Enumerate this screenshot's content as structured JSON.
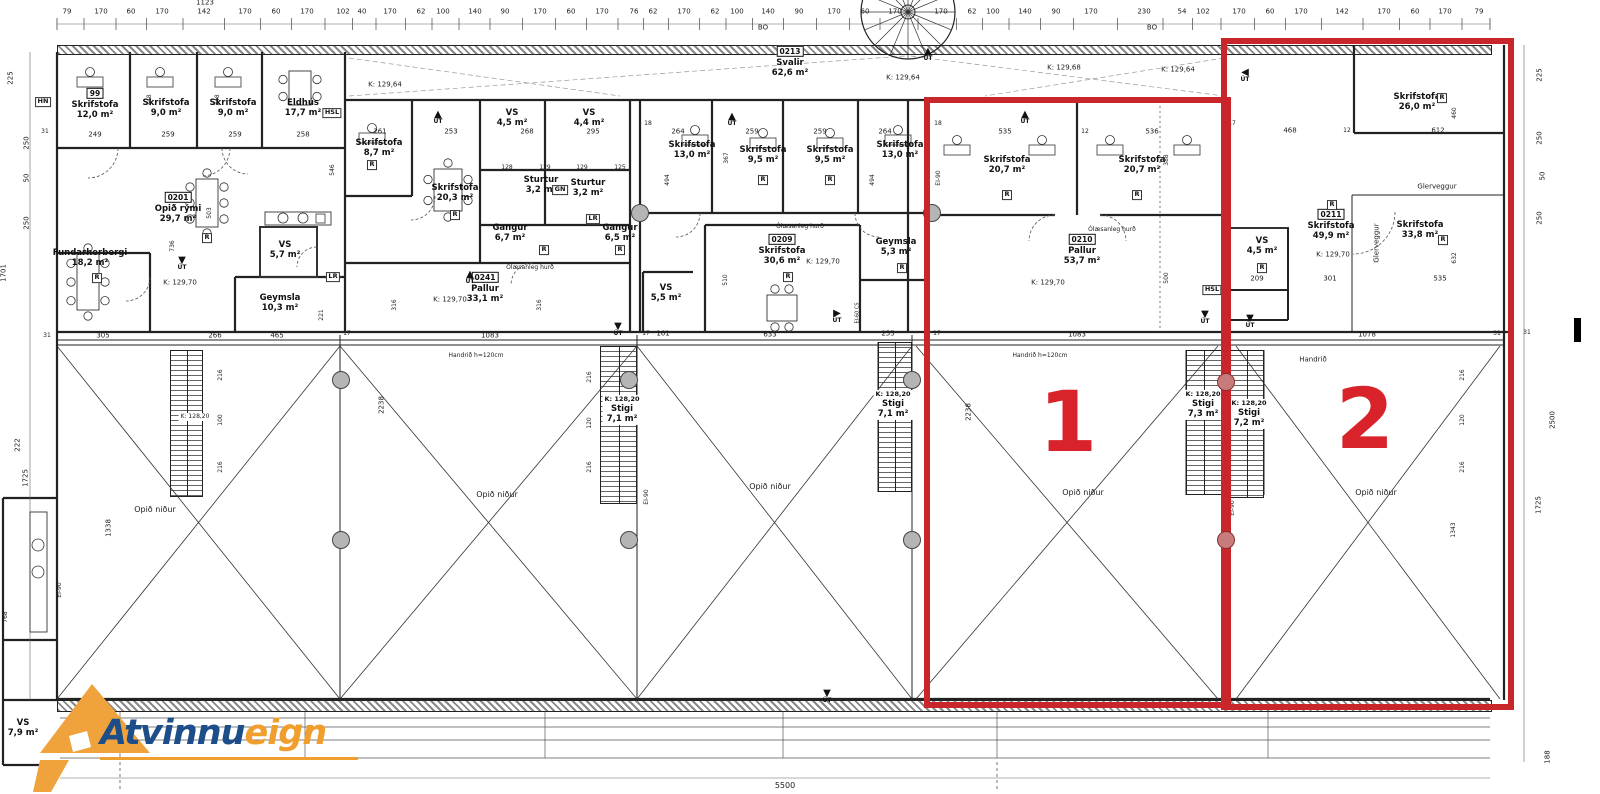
{
  "colors": {
    "red": "#c9262c",
    "red_number": "#d8232b",
    "logo_blue": "#1d4e89",
    "logo_orange": "#f09f2e"
  },
  "logo": {
    "word1": "Atvinnu",
    "word2": "eign"
  },
  "zones": [
    {
      "number": "1",
      "x": 924,
      "y": 97,
      "w": 307,
      "h": 611,
      "num_x": 1068,
      "num_y": 422
    },
    {
      "number": "2",
      "x": 1221,
      "y": 38,
      "w": 293,
      "h": 672,
      "num_x": 1365,
      "num_y": 419
    }
  ],
  "rooms": [
    {
      "id": "99",
      "n": "Skrifstofa",
      "a": "12,0 m²",
      "x": 95,
      "y": 104
    },
    {
      "n": "Skrifstofa",
      "a": "9,0 m²",
      "x": 166,
      "y": 108
    },
    {
      "n": "Skrifstofa",
      "a": "9,0 m²",
      "x": 233,
      "y": 108
    },
    {
      "n": "Eldhús",
      "a": "17,7 m²",
      "x": 303,
      "y": 108
    },
    {
      "id": "0201",
      "n": "Opið rými",
      "a": "29,7 m²",
      "x": 178,
      "y": 208
    },
    {
      "n": "Fundarherbergi",
      "a": "18,2 m²",
      "x": 90,
      "y": 258
    },
    {
      "n": "VS",
      "a": "5,7 m²",
      "x": 285,
      "y": 250
    },
    {
      "n": "Geymsla",
      "a": "10,3 m²",
      "x": 280,
      "y": 303
    },
    {
      "n": "Skrifstofa",
      "a": "8,7 m²",
      "x": 379,
      "y": 148
    },
    {
      "n": "Skrifstofa",
      "a": "20,3 m²",
      "x": 455,
      "y": 193
    },
    {
      "n": "VS",
      "a": "4,5 m²",
      "x": 512,
      "y": 118
    },
    {
      "n": "VS",
      "a": "4,4 m²",
      "x": 589,
      "y": 118
    },
    {
      "n": "Sturtur",
      "a": "3,2 m²",
      "x": 541,
      "y": 185
    },
    {
      "n": "Sturtur",
      "a": "3,2 m²",
      "x": 588,
      "y": 188
    },
    {
      "n": "Gangur",
      "a": "6,7 m²",
      "x": 510,
      "y": 233
    },
    {
      "n": "Gangur",
      "a": "6,5 m²",
      "x": 620,
      "y": 233
    },
    {
      "id": "0241",
      "n": "Pallur",
      "a": "33,1 m²",
      "x": 485,
      "y": 288
    },
    {
      "n": "Skrifstofa",
      "a": "13,0 m²",
      "x": 692,
      "y": 150
    },
    {
      "n": "Skrifstofa",
      "a": "9,5 m²",
      "x": 763,
      "y": 155
    },
    {
      "n": "Skrifstofa",
      "a": "9,5 m²",
      "x": 830,
      "y": 155
    },
    {
      "n": "Skrifstofa",
      "a": "13,0 m²",
      "x": 900,
      "y": 150
    },
    {
      "id": "0209",
      "n": "Skrifstofa",
      "a": "30,6 m²",
      "x": 782,
      "y": 250
    },
    {
      "n": "Geymsla",
      "a": "5,3 m²",
      "x": 896,
      "y": 247
    },
    {
      "n": "VS",
      "a": "5,5 m²",
      "x": 666,
      "y": 293
    },
    {
      "id": "0213",
      "n": "Svalir",
      "a": "62,6 m²",
      "x": 790,
      "y": 62
    },
    {
      "n": "Skrifstofa",
      "a": "20,7 m²",
      "x": 1007,
      "y": 165
    },
    {
      "n": "Skrifstofa",
      "a": "20,7 m²",
      "x": 1142,
      "y": 165
    },
    {
      "id": "0210",
      "n": "Pallur",
      "a": "53,7 m²",
      "x": 1082,
      "y": 250
    },
    {
      "n": "Skrifstofa",
      "a": "26,0 m²",
      "x": 1417,
      "y": 102
    },
    {
      "id": "0211",
      "n": "Skrifstofa",
      "a": "49,9 m²",
      "x": 1331,
      "y": 225
    },
    {
      "n": "Skrifstofa",
      "a": "33,8 m²",
      "x": 1420,
      "y": 230
    },
    {
      "n": "VS",
      "a": "4,5 m²",
      "x": 1262,
      "y": 246
    },
    {
      "n": "VS",
      "a": "7,9 m²",
      "x": 23,
      "y": 728
    },
    {
      "n": "Stigi",
      "a": "7,1 m²",
      "k": "K: 128,20",
      "x": 622,
      "y": 410,
      "bg": 1
    },
    {
      "n": "Stigi",
      "a": "7,1 m²",
      "k": "K: 128,20",
      "x": 893,
      "y": 405,
      "bg": 1
    },
    {
      "n": "Stigi",
      "a": "7,3 m²",
      "k": "K: 128,20",
      "x": 1203,
      "y": 405,
      "bg": 1
    },
    {
      "n": "Stigi",
      "a": "7,2 m²",
      "k": "K: 128,20",
      "x": 1249,
      "y": 414,
      "bg": 1
    }
  ],
  "labels": [
    [
      "79",
      67,
      12,
      7
    ],
    [
      "170",
      101,
      12,
      7
    ],
    [
      "60",
      131,
      12,
      7
    ],
    [
      "170",
      162,
      12,
      7
    ],
    [
      "142",
      204,
      12,
      7
    ],
    [
      "170",
      245,
      12,
      7
    ],
    [
      "60",
      276,
      12,
      7
    ],
    [
      "170",
      307,
      12,
      7
    ],
    [
      "102",
      343,
      12,
      7
    ],
    [
      "40",
      362,
      12,
      7
    ],
    [
      "170",
      390,
      12,
      7
    ],
    [
      "62",
      421,
      12,
      7
    ],
    [
      "100",
      443,
      12,
      7
    ],
    [
      "140",
      475,
      12,
      7
    ],
    [
      "90",
      505,
      12,
      7
    ],
    [
      "170",
      540,
      12,
      7
    ],
    [
      "60",
      571,
      12,
      7
    ],
    [
      "170",
      602,
      12,
      7
    ],
    [
      "76",
      634,
      12,
      7
    ],
    [
      "62",
      653,
      12,
      7
    ],
    [
      "170",
      684,
      12,
      7
    ],
    [
      "62",
      715,
      12,
      7
    ],
    [
      "100",
      737,
      12,
      7
    ],
    [
      "140",
      768,
      12,
      7
    ],
    [
      "90",
      799,
      12,
      7
    ],
    [
      "170",
      834,
      12,
      7
    ],
    [
      "60",
      865,
      12,
      7
    ],
    [
      "170",
      895,
      12,
      7
    ],
    [
      "170",
      941,
      12,
      7
    ],
    [
      "62",
      972,
      12,
      7
    ],
    [
      "100",
      993,
      12,
      7
    ],
    [
      "140",
      1025,
      12,
      7
    ],
    [
      "90",
      1056,
      12,
      7
    ],
    [
      "170",
      1091,
      12,
      7
    ],
    [
      "230",
      1144,
      12,
      7
    ],
    [
      "54",
      1182,
      12,
      7
    ],
    [
      "102",
      1203,
      12,
      7
    ],
    [
      "170",
      1239,
      12,
      7
    ],
    [
      "60",
      1270,
      12,
      7
    ],
    [
      "170",
      1301,
      12,
      7
    ],
    [
      "142",
      1342,
      12,
      7
    ],
    [
      "170",
      1384,
      12,
      7
    ],
    [
      "60",
      1415,
      12,
      7
    ],
    [
      "170",
      1445,
      12,
      7
    ],
    [
      "79",
      1479,
      12,
      7
    ],
    [
      "1123",
      205,
      3,
      7
    ],
    [
      "BO",
      763,
      28,
      7
    ],
    [
      "BO",
      1152,
      28,
      7
    ],
    [
      "225",
      11,
      78,
      7,
      1
    ],
    [
      "250",
      27,
      143,
      7,
      1
    ],
    [
      "50",
      27,
      178,
      7,
      1
    ],
    [
      "250",
      27,
      223,
      7,
      1
    ],
    [
      "1701",
      4,
      273,
      7,
      1
    ],
    [
      "222",
      18,
      445,
      7,
      1
    ],
    [
      "1725",
      26,
      478,
      7,
      1
    ],
    [
      "31",
      45,
      132,
      6
    ],
    [
      "31",
      47,
      336,
      6
    ],
    [
      "225",
      1540,
      75,
      7,
      1
    ],
    [
      "250",
      1540,
      138,
      7,
      1
    ],
    [
      "50",
      1543,
      176,
      7,
      1
    ],
    [
      "250",
      1540,
      218,
      7,
      1
    ],
    [
      "2500",
      1553,
      420,
      7,
      1
    ],
    [
      "1725",
      1539,
      505,
      7,
      1
    ],
    [
      "188",
      1548,
      757,
      7,
      1
    ],
    [
      "31",
      1527,
      333,
      6
    ],
    [
      "305",
      103,
      336,
      7
    ],
    [
      "266",
      215,
      336,
      7
    ],
    [
      "465",
      277,
      336,
      7
    ],
    [
      "1083",
      490,
      336,
      7
    ],
    [
      "161",
      663,
      334,
      7
    ],
    [
      "633",
      770,
      335,
      7
    ],
    [
      "255",
      888,
      334,
      7
    ],
    [
      "1083",
      1077,
      335,
      7
    ],
    [
      "1078",
      1367,
      335,
      7
    ],
    [
      "17",
      347,
      334,
      6
    ],
    [
      "17",
      646,
      334,
      6
    ],
    [
      "17",
      937,
      334,
      6
    ],
    [
      "31",
      1497,
      334,
      6
    ],
    [
      "249",
      95,
      135,
      7
    ],
    [
      "259",
      168,
      135,
      7
    ],
    [
      "259",
      235,
      135,
      7
    ],
    [
      "258",
      303,
      135,
      7
    ],
    [
      "261",
      380,
      132,
      7
    ],
    [
      "253",
      451,
      132,
      7
    ],
    [
      "268",
      527,
      132,
      7
    ],
    [
      "295",
      593,
      132,
      7
    ],
    [
      "264",
      678,
      132,
      7
    ],
    [
      "259",
      752,
      132,
      7
    ],
    [
      "259",
      820,
      132,
      7
    ],
    [
      "264",
      885,
      132,
      7
    ],
    [
      "535",
      1005,
      132,
      7
    ],
    [
      "536",
      1152,
      132,
      7
    ],
    [
      "468",
      1290,
      131,
      7
    ],
    [
      "612",
      1438,
      131,
      7
    ],
    [
      "18",
      648,
      124,
      6
    ],
    [
      "18",
      938,
      124,
      6
    ],
    [
      "12",
      1085,
      132,
      6
    ],
    [
      "17",
      1232,
      124,
      6
    ],
    [
      "12",
      1347,
      131,
      6
    ],
    [
      "128",
      507,
      168,
      6
    ],
    [
      "129",
      545,
      168,
      6
    ],
    [
      "129",
      582,
      168,
      6
    ],
    [
      "125",
      620,
      168,
      6
    ],
    [
      "209",
      1257,
      279,
      7
    ],
    [
      "301",
      1330,
      279,
      7
    ],
    [
      "535",
      1440,
      279,
      7
    ],
    [
      "348",
      150,
      100,
      6,
      1
    ],
    [
      "348",
      218,
      100,
      6,
      1
    ],
    [
      "546",
      333,
      170,
      6,
      1
    ],
    [
      "367",
      727,
      158,
      6,
      1
    ],
    [
      "494",
      668,
      180,
      6,
      1
    ],
    [
      "494",
      873,
      180,
      6,
      1
    ],
    [
      "388",
      1167,
      160,
      6,
      1
    ],
    [
      "500",
      1167,
      278,
      6,
      1
    ],
    [
      "510",
      726,
      280,
      6,
      1
    ],
    [
      "503",
      210,
      213,
      6,
      1
    ],
    [
      "736",
      173,
      246,
      6,
      1
    ],
    [
      "316",
      395,
      305,
      6,
      1
    ],
    [
      "316",
      540,
      305,
      6,
      1
    ],
    [
      "221",
      322,
      315,
      6,
      1
    ],
    [
      "768",
      6,
      617,
      6,
      1
    ],
    [
      "460",
      1455,
      113,
      6,
      1
    ],
    [
      "632",
      1455,
      258,
      6,
      1
    ],
    [
      "1338",
      109,
      528,
      7,
      1
    ],
    [
      "1343",
      1454,
      530,
      6,
      1
    ],
    [
      "2238",
      382,
      405,
      7,
      1
    ],
    [
      "2238",
      969,
      412,
      7,
      1
    ],
    [
      "216",
      221,
      375,
      6,
      1
    ],
    [
      "100",
      221,
      420,
      6,
      1
    ],
    [
      "216",
      221,
      467,
      6,
      1
    ],
    [
      "216",
      590,
      377,
      6,
      1
    ],
    [
      "120",
      590,
      423,
      6,
      1
    ],
    [
      "216",
      590,
      467,
      6,
      1
    ],
    [
      "216",
      1463,
      375,
      6,
      1
    ],
    [
      "120",
      1463,
      420,
      6,
      1
    ],
    [
      "216",
      1463,
      467,
      6,
      1
    ],
    [
      "EI-90",
      939,
      178,
      6,
      1
    ],
    [
      "EI-90",
      647,
      497,
      6,
      1
    ],
    [
      "EI-90",
      1233,
      508,
      6,
      1
    ],
    [
      "EI-90",
      60,
      590,
      6,
      1
    ],
    [
      "EI-60 CS",
      858,
      313,
      5,
      1
    ],
    [
      "Ólæsanleg hurð",
      530,
      268,
      6
    ],
    [
      "Ólæsanleg hurð",
      800,
      227,
      6
    ],
    [
      "Ólæsanleg hurð",
      1112,
      230,
      6
    ],
    [
      "Handrið h=120cm",
      476,
      356,
      6
    ],
    [
      "Handrið h=120cm",
      1040,
      356,
      6
    ],
    [
      "Handrið",
      1313,
      360,
      7
    ],
    [
      "Glerveggur",
      1437,
      187,
      7
    ],
    [
      "Glerveggur",
      1377,
      243,
      7,
      1
    ],
    [
      "Opið niður",
      155,
      510,
      8
    ],
    [
      "Opið niður",
      497,
      495,
      8
    ],
    [
      "Opið niður",
      770,
      487,
      8
    ],
    [
      "Opið niður",
      1083,
      493,
      8
    ],
    [
      "Opið niður",
      1376,
      493,
      8
    ],
    [
      "5500",
      785,
      786,
      8
    ],
    [
      "K: 129,64",
      385,
      85,
      7
    ],
    [
      "K: 129,64",
      903,
      78,
      7
    ],
    [
      "K: 129,64",
      1178,
      70,
      7
    ],
    [
      "K: 129,68",
      1064,
      68,
      7
    ],
    [
      "K: 129,70",
      180,
      283,
      7
    ],
    [
      "K: 129,70",
      450,
      300,
      7
    ],
    [
      "K: 129,70",
      823,
      262,
      7
    ],
    [
      "K: 129,70",
      1048,
      283,
      7
    ],
    [
      "K: 129,70",
      1333,
      255,
      7
    ],
    [
      "K: 128,20",
      195,
      417,
      6,
      0,
      1
    ]
  ],
  "tags": [
    [
      "R",
      207,
      238
    ],
    [
      "R",
      372,
      165
    ],
    [
      "R",
      455,
      215
    ],
    [
      "R",
      544,
      250
    ],
    [
      "R",
      620,
      250
    ],
    [
      "R",
      788,
      277
    ],
    [
      "R",
      902,
      268
    ],
    [
      "R",
      1007,
      195
    ],
    [
      "R",
      1137,
      195
    ],
    [
      "R",
      1332,
      205
    ],
    [
      "R",
      1443,
      240
    ],
    [
      "R",
      1262,
      268
    ],
    [
      "R",
      1442,
      98
    ],
    [
      "R",
      97,
      278
    ],
    [
      "R",
      763,
      180
    ],
    [
      "R",
      830,
      180
    ],
    [
      "HN",
      43,
      102
    ],
    [
      "HSL",
      332,
      113
    ],
    [
      "HSL",
      1212,
      290
    ],
    [
      "LR",
      593,
      219
    ],
    [
      "LR",
      333,
      277
    ],
    [
      "GN",
      560,
      190
    ]
  ],
  "ut_markers": [
    [
      438,
      118,
      "up"
    ],
    [
      182,
      264,
      "down"
    ],
    [
      470,
      278,
      "up"
    ],
    [
      732,
      120,
      "up"
    ],
    [
      837,
      317,
      "right"
    ],
    [
      1025,
      118,
      "up"
    ],
    [
      928,
      55,
      "up"
    ],
    [
      1245,
      76,
      "left"
    ],
    [
      1205,
      318,
      "down"
    ],
    [
      1250,
      322,
      "down"
    ],
    [
      618,
      330,
      "down"
    ],
    [
      827,
      697,
      "down"
    ]
  ],
  "stairs": [
    [
      170,
      350,
      33,
      147
    ],
    [
      600,
      346,
      37,
      158
    ],
    [
      878,
      342,
      34,
      150
    ],
    [
      1186,
      350,
      36,
      145
    ],
    [
      1230,
      350,
      34,
      148
    ]
  ],
  "columns": [
    [
      640,
      213,
      0
    ],
    [
      932,
      213,
      0
    ],
    [
      341,
      380,
      0
    ],
    [
      341,
      540,
      0
    ],
    [
      629,
      380,
      0
    ],
    [
      629,
      540,
      0
    ],
    [
      912,
      380,
      0
    ],
    [
      912,
      540,
      0
    ],
    [
      1226,
      382,
      1
    ],
    [
      1226,
      540,
      1
    ]
  ]
}
